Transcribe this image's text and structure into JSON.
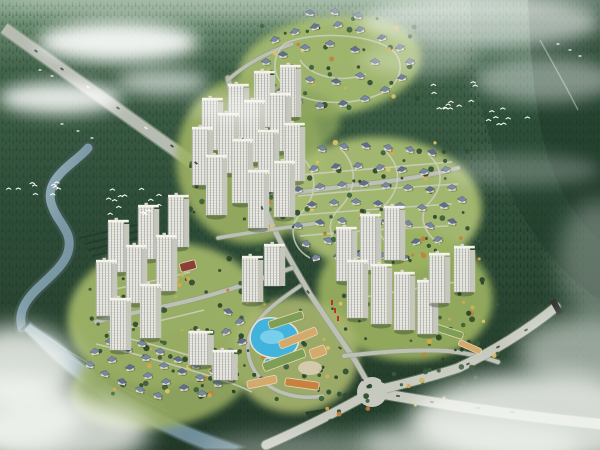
{
  "scene": {
    "kind": "aerial-masterplan-rendering",
    "palette": {
      "sky_haze": "#ffffff",
      "forest_top": "#7fa083",
      "forest_hi": "#3f6148",
      "forest_mid": "#2e4e39",
      "forest_lo": "#223a2a",
      "conifer": "#14241a",
      "mountain": "#26452f",
      "mountain_dark": "#1d3326",
      "river_hi": "#a9c3ca",
      "river_lo": "#6f8e9b",
      "road": "#bcc0b5",
      "road_big": "#c6c9be",
      "lane": "#ccd0c0",
      "estate_green": "#a3b96e",
      "tower_face": "#ecebe2",
      "tower_side": "#c6c7bc",
      "tower_top": "#f4f3ea",
      "tower_win": "#9aa0a4",
      "villa_body": "#ded8c8",
      "villa_roof": "#7688a3",
      "villa_roof_dark": "#5d6f8e",
      "pool": "#41b3dd",
      "pool_hi": "#85d6ef",
      "deck": "#e8e2d0",
      "green": "#7f9f58",
      "tan": "#d4a96c",
      "orange": "#c8813f",
      "maroon": "#8a4038",
      "flag_red": "#c03028",
      "car_dark": "#3a3f42",
      "car_light": "#eeeeee",
      "bird": "#ffffff"
    },
    "terrain_blobs": [
      [
        330,
        66,
        92,
        50,
        -8,
        "#a3b96e",
        0.95
      ],
      [
        250,
        160,
        74,
        84,
        0,
        "#9db163",
        0.9
      ],
      [
        382,
        205,
        100,
        68,
        4,
        "#a8bc72",
        0.95
      ],
      [
        165,
        315,
        98,
        72,
        -6,
        "#9fb468",
        0.95
      ],
      [
        405,
        295,
        88,
        66,
        6,
        "#9ab160",
        0.92
      ],
      [
        295,
        355,
        64,
        58,
        0,
        "#a8b66e",
        0.9
      ],
      [
        160,
        382,
        92,
        46,
        -10,
        "#97ab62",
        0.9
      ],
      [
        300,
        120,
        40,
        30,
        0,
        "#8aa45c",
        0.8
      ]
    ],
    "highway": {
      "path": "M4,28 L214,178",
      "width": 11
    },
    "river": {
      "path": "M88,148 C80,158 62,168 54,182 C46,196 52,208 58,218 C66,230 72,238 68,252 C64,266 48,278 36,290 C24,302 18,314 22,328",
      "width": 9
    },
    "wetland": {
      "path": "M30,322 C40,330 52,336 64,346 C80,360 96,374 116,388 C140,404 168,418 198,430 C218,438 232,442 244,447 L236,450 L205,450 C178,440 150,426 122,410 C98,396 76,380 58,364 C44,352 32,338 22,330 Z"
    },
    "waves": [
      "M60,352 C90,370 130,394 170,412",
      "M48,338 C80,358 120,384 164,406"
    ],
    "roads": [
      {
        "name": "spine",
        "path": "M228,78 C238,128 248,158 262,200 C276,238 294,266 310,294 C326,318 344,344 356,362 C364,376 370,386 372,392",
        "w": 5
      },
      {
        "name": "east-upper",
        "path": "M256,198 C300,192 330,188 366,184 C400,180 428,176 458,168",
        "w": 4
      },
      {
        "name": "west-lowerleft",
        "path": "M292,268 C258,280 224,292 192,300 C160,308 124,314 96,322",
        "w": 4
      },
      {
        "name": "cross-mid",
        "path": "M218,238 C250,232 284,228 318,223",
        "w": 3.5
      },
      {
        "name": "top-link",
        "path": "M228,80 C246,64 268,52 292,44",
        "w": 3.5
      },
      {
        "name": "right-cluster-base",
        "path": "M344,356 C380,352 414,349 448,351 C468,353 484,357 498,362",
        "w": 4
      },
      {
        "name": "boulevard-se",
        "path": "M372,392 C430,402 500,414 600,424",
        "w": 10,
        "big": true
      },
      {
        "name": "arm-sw",
        "path": "M372,392 C340,410 305,428 266,445",
        "w": 9,
        "big": true
      },
      {
        "name": "ramp-east",
        "path": "M378,390 C420,380 440,374 458,368 C492,352 528,330 556,307",
        "w": 9,
        "big": true
      },
      {
        "name": "commercial-loop",
        "path": "M300,286 C280,300 262,312 252,330 C244,346 248,366 262,380 C276,394 300,400 322,396",
        "w": 3.5
      }
    ],
    "junction": {
      "x": 372,
      "y": 392,
      "r": 15
    },
    "ramp_end": {
      "x": 556,
      "y": 306,
      "rot": -29
    },
    "lanes": [
      "M284,44 C270,60 272,80 292,92 C314,105 352,106 380,94 C402,84 406,62 392,50 C372,34 312,30 284,44",
      "M300,60 C310,76 340,84 366,74",
      "M296,152 C320,170 318,196 300,214 C288,228 292,248 310,258",
      "M340,148 C360,168 356,192 338,210 C324,224 330,244 350,254",
      "M384,150 C404,168 400,190 384,206 C372,220 378,240 396,250",
      "M428,154 C446,170 442,190 428,204 C418,216 424,234 440,244",
      "M292,176 C330,172 380,168 452,162",
      "M298,196 C340,192 390,188 458,184",
      "M290,216 C335,212 390,208 452,204",
      "M300,236 C345,232 395,228 448,226",
      "M96,344 C130,352 170,364 210,376 C226,381 240,386 252,392",
      "M110,334 C145,342 185,354 225,366",
      "M348,300 C380,294 420,288 456,282",
      "M100,292 C130,286 160,280 190,272",
      "M108,332 C140,326 172,318 204,310"
    ],
    "villas": {
      "top": [
        [
          275,
          40
        ],
        [
          295,
          32
        ],
        [
          315,
          27
        ],
        [
          338,
          25
        ],
        [
          360,
          30
        ],
        [
          382,
          38
        ],
        [
          400,
          48
        ],
        [
          410,
          62
        ],
        [
          402,
          78
        ],
        [
          385,
          90
        ],
        [
          365,
          99
        ],
        [
          343,
          104
        ],
        [
          320,
          106
        ],
        [
          298,
          101
        ],
        [
          280,
          92
        ],
        [
          268,
          78
        ],
        [
          266,
          62
        ],
        [
          283,
          55
        ],
        [
          305,
          48
        ],
        [
          330,
          44
        ],
        [
          355,
          50
        ],
        [
          375,
          62
        ],
        [
          360,
          76
        ],
        [
          336,
          82
        ],
        [
          310,
          80
        ],
        [
          292,
          68
        ],
        [
          310,
          13
        ],
        [
          335,
          12
        ],
        [
          358,
          16
        ]
      ],
      "middle": [
        [
          300,
          152
        ],
        [
          322,
          149
        ],
        [
          344,
          147
        ],
        [
          366,
          146
        ],
        [
          388,
          148
        ],
        [
          410,
          150
        ],
        [
          432,
          153
        ],
        [
          292,
          172
        ],
        [
          314,
          169
        ],
        [
          336,
          167
        ],
        [
          358,
          166
        ],
        [
          380,
          168
        ],
        [
          402,
          170
        ],
        [
          424,
          172
        ],
        [
          446,
          170
        ],
        [
          298,
          190
        ],
        [
          320,
          187
        ],
        [
          342,
          185
        ],
        [
          364,
          184
        ],
        [
          386,
          186
        ],
        [
          408,
          188
        ],
        [
          430,
          190
        ],
        [
          452,
          188
        ],
        [
          290,
          208
        ],
        [
          312,
          205
        ],
        [
          334,
          203
        ],
        [
          356,
          202
        ],
        [
          378,
          204
        ],
        [
          400,
          206
        ],
        [
          422,
          208
        ],
        [
          444,
          206
        ],
        [
          462,
          200
        ],
        [
          298,
          226
        ],
        [
          320,
          223
        ],
        [
          342,
          221
        ],
        [
          364,
          220
        ],
        [
          386,
          222
        ],
        [
          408,
          224
        ],
        [
          430,
          226
        ],
        [
          452,
          222
        ],
        [
          306,
          244
        ],
        [
          328,
          241
        ],
        [
          350,
          239
        ],
        [
          372,
          238
        ],
        [
          394,
          240
        ],
        [
          416,
          242
        ],
        [
          438,
          240
        ],
        [
          316,
          258
        ],
        [
          338,
          256
        ],
        [
          360,
          255
        ],
        [
          382,
          256
        ],
        [
          404,
          258
        ]
      ],
      "lower": [
        [
          95,
          352
        ],
        [
          112,
          360
        ],
        [
          130,
          368
        ],
        [
          148,
          376
        ],
        [
          166,
          382
        ],
        [
          184,
          388
        ],
        [
          202,
          394
        ],
        [
          110,
          342
        ],
        [
          128,
          350
        ],
        [
          146,
          358
        ],
        [
          164,
          366
        ],
        [
          182,
          372
        ],
        [
          200,
          378
        ],
        [
          218,
          384
        ],
        [
          124,
          336
        ],
        [
          142,
          344
        ],
        [
          160,
          352
        ],
        [
          178,
          360
        ],
        [
          196,
          366
        ],
        [
          214,
          372
        ],
        [
          230,
          378
        ],
        [
          90,
          365
        ],
        [
          105,
          374
        ],
        [
          122,
          382
        ],
        [
          140,
          390
        ],
        [
          158,
          396
        ],
        [
          228,
          312
        ],
        [
          240,
          322
        ],
        [
          226,
          332
        ],
        [
          242,
          342
        ],
        [
          230,
          352
        ]
      ]
    },
    "towers": {
      "upper": [
        [
          210,
          150,
          50
        ],
        [
          236,
          138,
          52
        ],
        [
          262,
          127,
          54
        ],
        [
          288,
          117,
          50
        ],
        [
          200,
          185,
          56
        ],
        [
          226,
          173,
          58
        ],
        [
          252,
          162,
          60
        ],
        [
          278,
          151,
          56
        ],
        [
          214,
          215,
          58
        ],
        [
          240,
          203,
          62
        ],
        [
          266,
          192,
          60
        ],
        [
          292,
          181,
          56
        ],
        [
          256,
          228,
          56
        ],
        [
          282,
          217,
          54
        ]
      ],
      "lower_left": [
        [
          116,
          272,
          50
        ],
        [
          146,
          259,
          52
        ],
        [
          176,
          247,
          50
        ],
        [
          104,
          316,
          54
        ],
        [
          134,
          303,
          56
        ],
        [
          164,
          291,
          54
        ],
        [
          118,
          350,
          50
        ],
        [
          148,
          338,
          52
        ],
        [
          250,
          302,
          44
        ],
        [
          272,
          286,
          40
        ]
      ],
      "lower_right": [
        [
          344,
          281,
          52
        ],
        [
          368,
          270,
          54
        ],
        [
          392,
          260,
          52
        ],
        [
          355,
          318,
          56
        ],
        [
          379,
          324,
          58
        ],
        [
          402,
          330,
          56
        ],
        [
          425,
          334,
          52
        ],
        [
          437,
          303,
          48
        ],
        [
          462,
          292,
          44
        ]
      ],
      "slabs": [
        [
          198,
          365,
          32
        ],
        [
          222,
          380,
          28
        ]
      ]
    },
    "commercial": {
      "buildings": [
        [
          286,
          320,
          36,
          8,
          -18,
          "green"
        ],
        [
          298,
          338,
          40,
          8,
          -22,
          "tan"
        ],
        [
          284,
          360,
          44,
          9,
          -20,
          "green"
        ],
        [
          262,
          382,
          30,
          8,
          -12,
          "tan"
        ],
        [
          302,
          384,
          34,
          8,
          8,
          "orange"
        ],
        [
          318,
          352,
          16,
          10,
          -20,
          "tan"
        ],
        [
          444,
          330,
          40,
          7,
          18,
          "green"
        ],
        [
          470,
          347,
          24,
          6,
          24,
          "tan"
        ],
        [
          188,
          266,
          16,
          9,
          -15,
          "maroon"
        ]
      ],
      "plaza": [
        310,
        368,
        12,
        7
      ],
      "pool": "M258,322 C250,330 248,342 256,350 C264,358 282,360 292,352 C300,346 300,332 292,326 C282,318 266,316 258,322 Z",
      "small_pool": [
        268,
        362,
        4
      ],
      "flags": [
        [
          331,
          300
        ],
        [
          334,
          308
        ],
        [
          337,
          316
        ]
      ]
    },
    "tree_regions": [
      [
        188,
        118,
        120,
        112,
        38
      ],
      [
        250,
        18,
        172,
        96,
        30
      ],
      [
        290,
        140,
        192,
        132,
        48
      ],
      [
        88,
        248,
        184,
        112,
        42
      ],
      [
        335,
        238,
        150,
        112,
        40
      ],
      [
        85,
        328,
        172,
        72,
        32
      ],
      [
        240,
        294,
        112,
        108,
        26
      ],
      [
        410,
        300,
        90,
        70,
        20
      ],
      [
        300,
        370,
        180,
        46,
        22
      ]
    ],
    "tree_dark_palette": [
      "#2e4c30",
      "#3a5c3a",
      "#274427"
    ],
    "tree_warm_palette": [
      "#d8a848",
      "#c9b45a",
      "#c37f3a",
      "#dfc36a"
    ],
    "forest_patch": "M305,412 L462,385 L505,450 L325,450 Z",
    "terraces": [
      "M80,238 L140,224",
      "M84,244 L144,230",
      "M88,250 L148,236",
      "M92,256 L152,242"
    ],
    "hamlets": [
      [
        40,
        70
      ],
      [
        52,
        76
      ],
      [
        62,
        124
      ],
      [
        78,
        131
      ],
      [
        92,
        138
      ],
      [
        558,
        44
      ],
      [
        570,
        50
      ],
      [
        580,
        56
      ]
    ],
    "distant_road": "M540,40 C552,62 566,86 578,110",
    "bird_flocks": [
      [
        35,
        188,
        10,
        30
      ],
      [
        138,
        204,
        14,
        40
      ],
      [
        468,
        96,
        12,
        36
      ],
      [
        508,
        116,
        8,
        24
      ]
    ],
    "cars": [
      [
        36,
        51,
        35
      ],
      [
        62,
        69,
        35
      ],
      [
        88,
        87,
        35,
        "w"
      ],
      [
        118,
        108,
        35
      ],
      [
        146,
        128,
        35,
        "w"
      ],
      [
        172,
        146,
        35
      ],
      [
        196,
        163,
        35
      ],
      [
        398,
        396,
        8
      ],
      [
        432,
        402,
        9
      ],
      [
        478,
        408,
        9
      ],
      [
        512,
        412,
        8
      ],
      [
        468,
        364,
        -24
      ],
      [
        498,
        347,
        -27
      ],
      [
        526,
        330,
        -27
      ],
      [
        262,
        208,
        72
      ],
      [
        290,
        250,
        62
      ],
      [
        308,
        292,
        55
      ],
      [
        340,
        348,
        35
      ],
      [
        362,
        380,
        18
      ],
      [
        330,
        420,
        -30
      ],
      [
        300,
        436,
        -28
      ]
    ],
    "clouds": [
      [
        118,
        42,
        80,
        20,
        0.9
      ],
      [
        60,
        98,
        62,
        16,
        0.85
      ],
      [
        162,
        82,
        46,
        13,
        0.6
      ],
      [
        230,
        108,
        40,
        12,
        0.35
      ],
      [
        480,
        22,
        120,
        26,
        0.55
      ],
      [
        545,
        80,
        70,
        22,
        0.4
      ],
      [
        520,
        170,
        80,
        16,
        0.25
      ],
      [
        420,
        60,
        60,
        16,
        0.3
      ],
      [
        300,
        2,
        320,
        16,
        0.3
      ]
    ],
    "fog": [
      [
        18,
        368,
        60,
        42,
        0.85
      ],
      [
        60,
        432,
        90,
        34,
        0.8
      ],
      [
        12,
        414,
        70,
        40,
        0.8
      ],
      [
        540,
        420,
        130,
        48,
        0.85
      ],
      [
        588,
        352,
        70,
        36,
        0.55
      ],
      [
        470,
        444,
        110,
        26,
        0.6
      ],
      [
        320,
        450,
        120,
        16,
        0.4
      ],
      [
        598,
        260,
        40,
        60,
        0.3
      ]
    ]
  }
}
